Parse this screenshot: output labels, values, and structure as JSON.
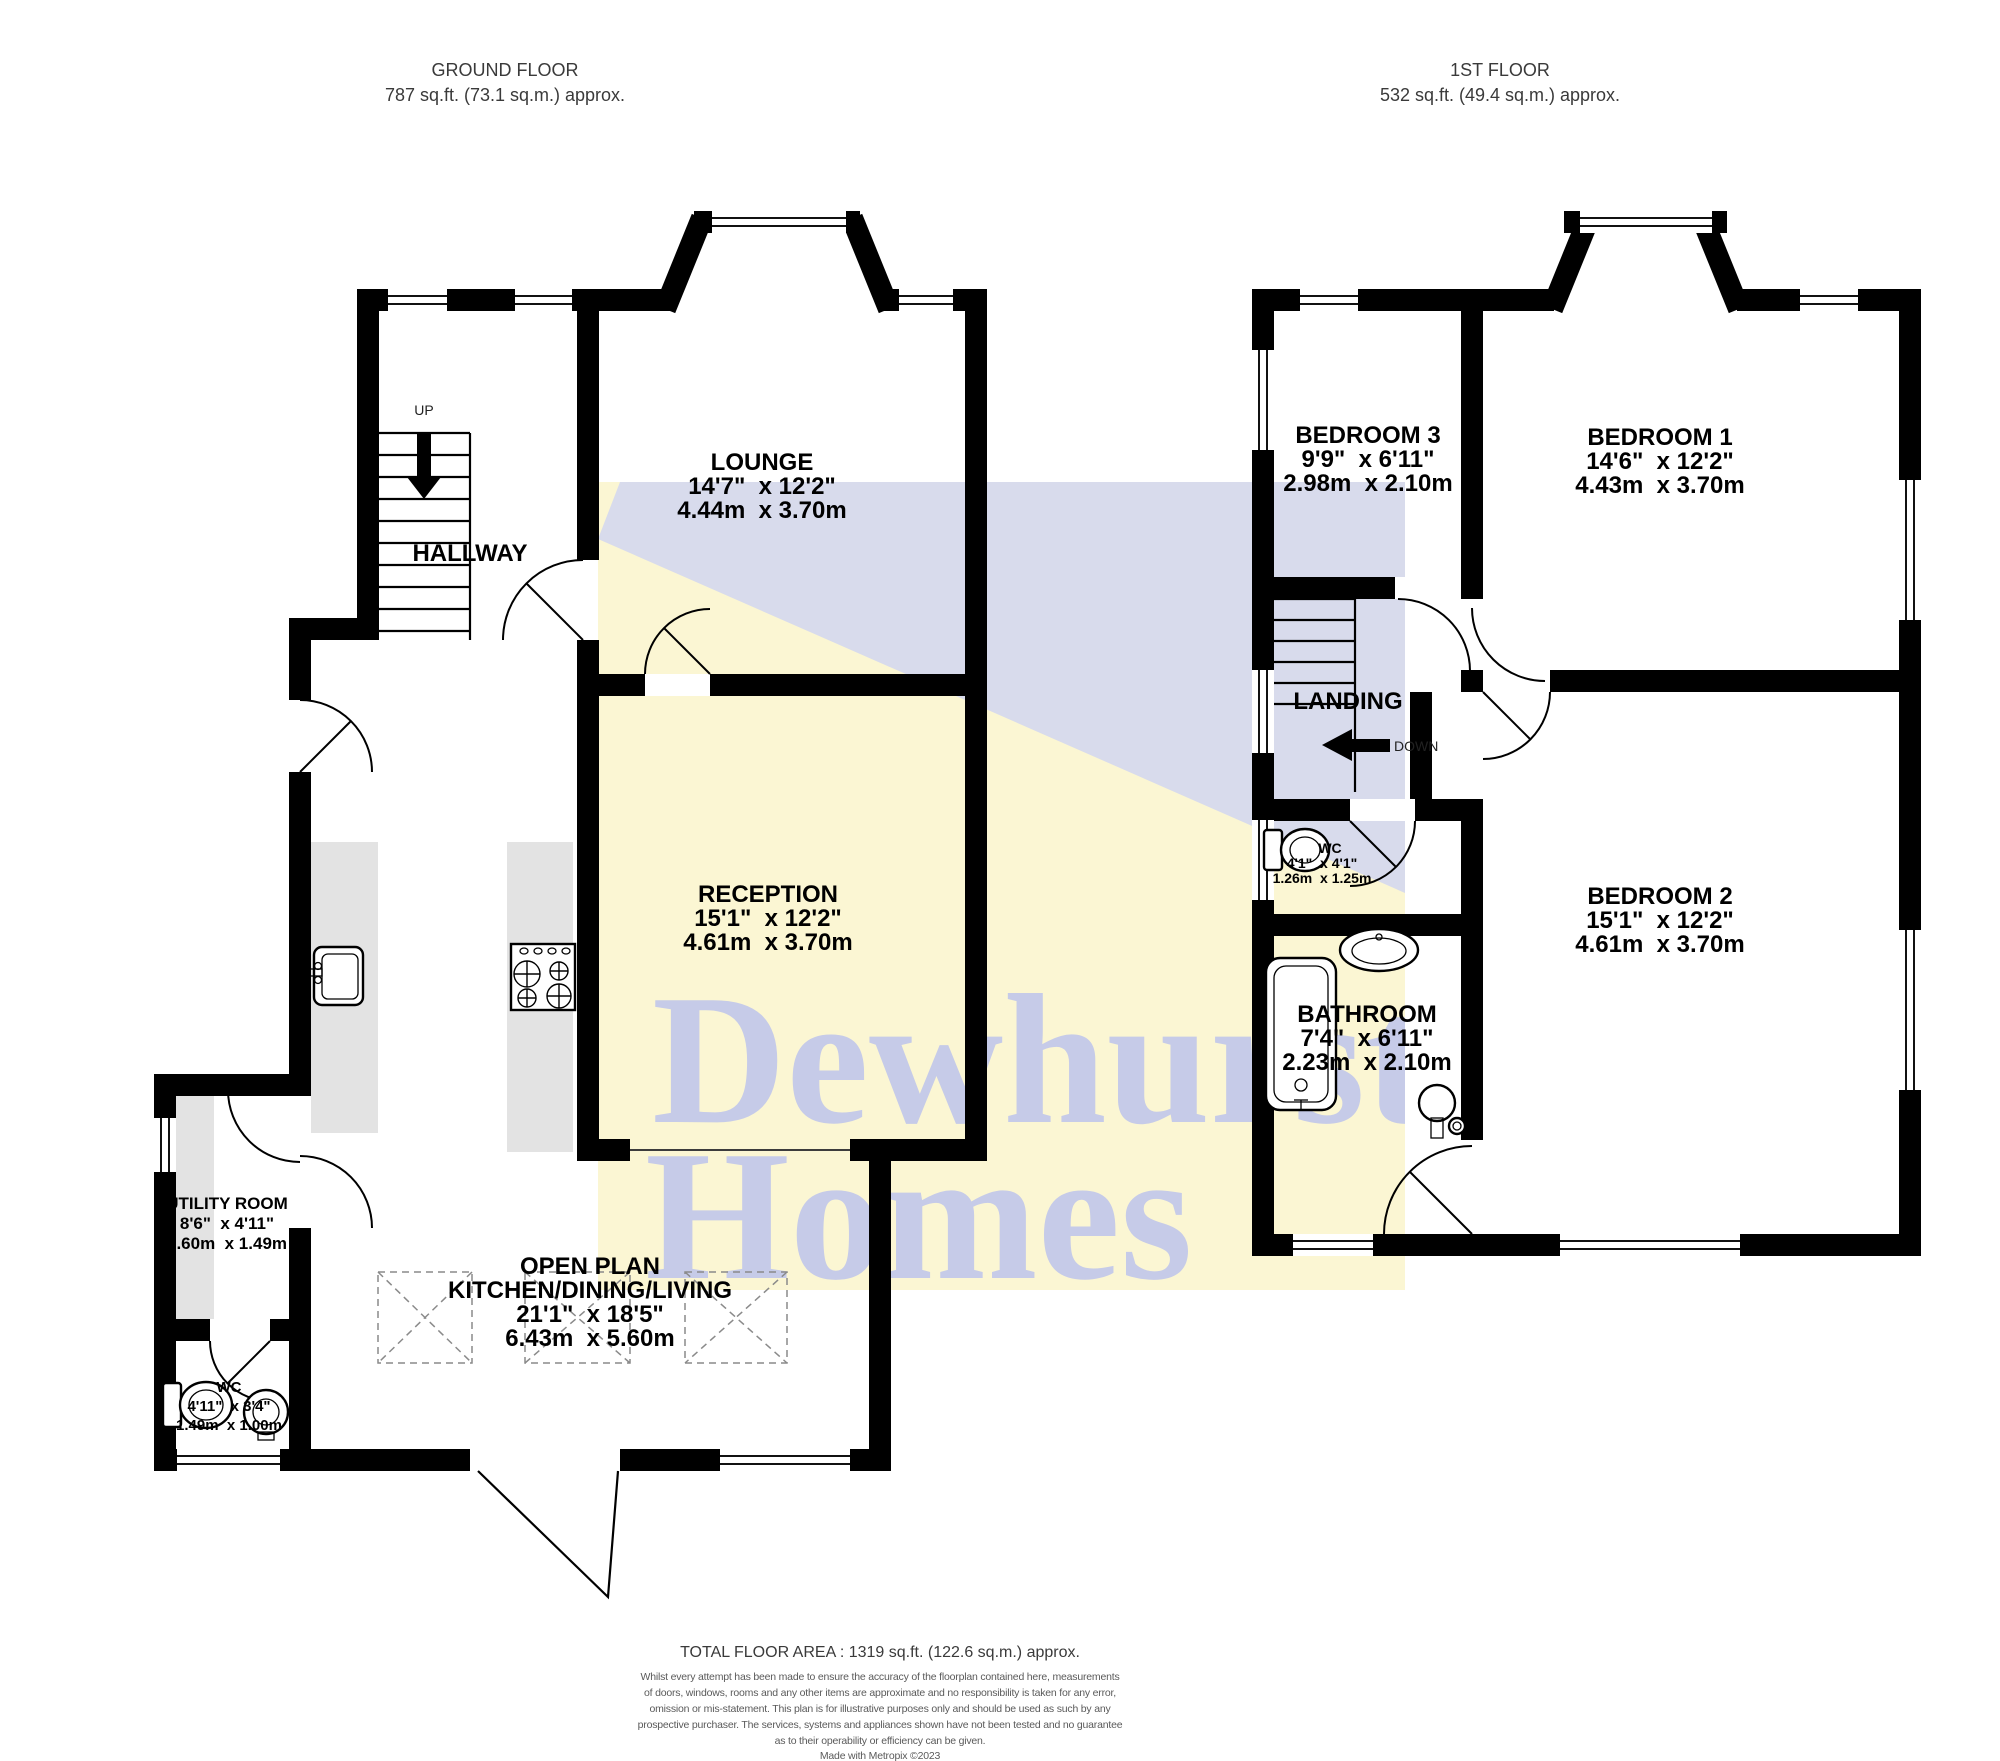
{
  "header": {
    "ground_floor": {
      "title": "GROUND FLOOR",
      "area": "787 sq.ft. (73.1 sq.m.) approx."
    },
    "first_floor": {
      "title": "1ST FLOOR",
      "area": "532 sq.ft. (49.4 sq.m.) approx."
    }
  },
  "ground_floor": {
    "hallway_label": "HALLWAY",
    "stairs_label": "UP",
    "lounge": {
      "name": "LOUNGE",
      "imperial": "14'7\"  x 12'2\"",
      "metric": "4.44m  x 3.70m"
    },
    "reception": {
      "name": "RECEPTION",
      "imperial": "15'1\"  x 12'2\"",
      "metric": "4.61m  x 3.70m"
    },
    "utility": {
      "name": "UTILITY ROOM",
      "imperial": "8'6\"  x 4'11\"",
      "metric": "2.60m  x 1.49m"
    },
    "wc": {
      "name": "WC",
      "imperial": "4'11\"  x 3'4\"",
      "metric": "1.49m  x 1.00m"
    },
    "kitchen": {
      "name_line1": "OPEN PLAN",
      "name_line2": "KITCHEN/DINING/LIVING",
      "imperial": "21'1\"  x 18'5\"",
      "metric": "6.43m  x 5.60m"
    }
  },
  "first_floor": {
    "landing_label": "LANDING",
    "stairs_label": "DOWN",
    "bedroom3": {
      "name": "BEDROOM 3",
      "imperial": "9'9\"  x 6'11\"",
      "metric": "2.98m  x 2.10m"
    },
    "bedroom1": {
      "name": "BEDROOM 1",
      "imperial": "14'6\"  x 12'2\"",
      "metric": "4.43m  x 3.70m"
    },
    "bedroom2": {
      "name": "BEDROOM 2",
      "imperial": "15'1\"  x 12'2\"",
      "metric": "4.61m  x 3.70m"
    },
    "wc": {
      "name": "WC",
      "imperial": "4'1\"  x 4'1\"",
      "metric": "1.26m  x 1.25m"
    },
    "bathroom": {
      "name": "BATHROOM",
      "imperial": "7'4\"  x 6'11\"",
      "metric": "2.23m  x 2.10m"
    }
  },
  "watermark": {
    "line1": "Dewhurst",
    "line2": "Homes",
    "yellow": "#fbf6d3",
    "lavender": "#d8dbec",
    "text_color": "#c6cbe8"
  },
  "footer": {
    "total": "TOTAL FLOOR AREA : 1319 sq.ft. (122.6 sq.m.) approx.",
    "disclaimer": [
      "Whilst every attempt has been made to ensure the accuracy of the floorplan contained here, measurements",
      "of doors, windows, rooms and any other items are approximate and no responsibility is taken for any error,",
      "omission or mis-statement. This plan is for illustrative purposes only and should be used as such by any",
      "prospective purchaser. The services, systems and appliances shown have not been tested and no guarantee",
      "as to their operability or efficiency can be given.",
      "Made with Metropix ©2023"
    ]
  }
}
